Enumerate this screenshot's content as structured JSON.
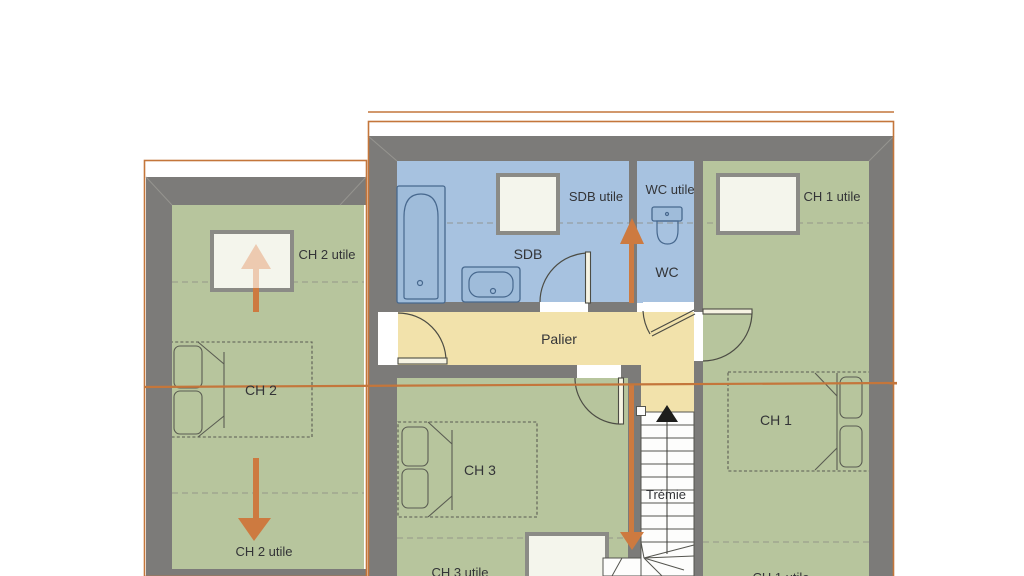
{
  "floor_plan": {
    "colors": {
      "room_green": "#b7c59d",
      "room_blue": "#a7c2e0",
      "hall_tan": "#f2e2ab",
      "wall_gray": "#7c7b79",
      "outline_orange": "#c4763b",
      "arrow_orange": "#cd7a40",
      "arrow_faded": "#edcab0",
      "window_fill": "#f4f5ec",
      "window_border": "#8b8b86"
    },
    "labels": {
      "ch2_utile_top": "CH 2 utile",
      "ch2": "CH 2",
      "ch2_utile_bottom": "CH 2 utile",
      "sdb_utile": "SDB utile",
      "sdb": "SDB",
      "wc_utile": "WC utile",
      "wc": "WC",
      "ch1_utile_top": "CH 1 utile",
      "ch1": "CH 1",
      "ch1_utile_bottom": "CH 1 utile",
      "palier": "Palier",
      "ch3": "CH 3",
      "ch3_utile": "CH 3 utile",
      "tremie": "Trémie"
    }
  }
}
